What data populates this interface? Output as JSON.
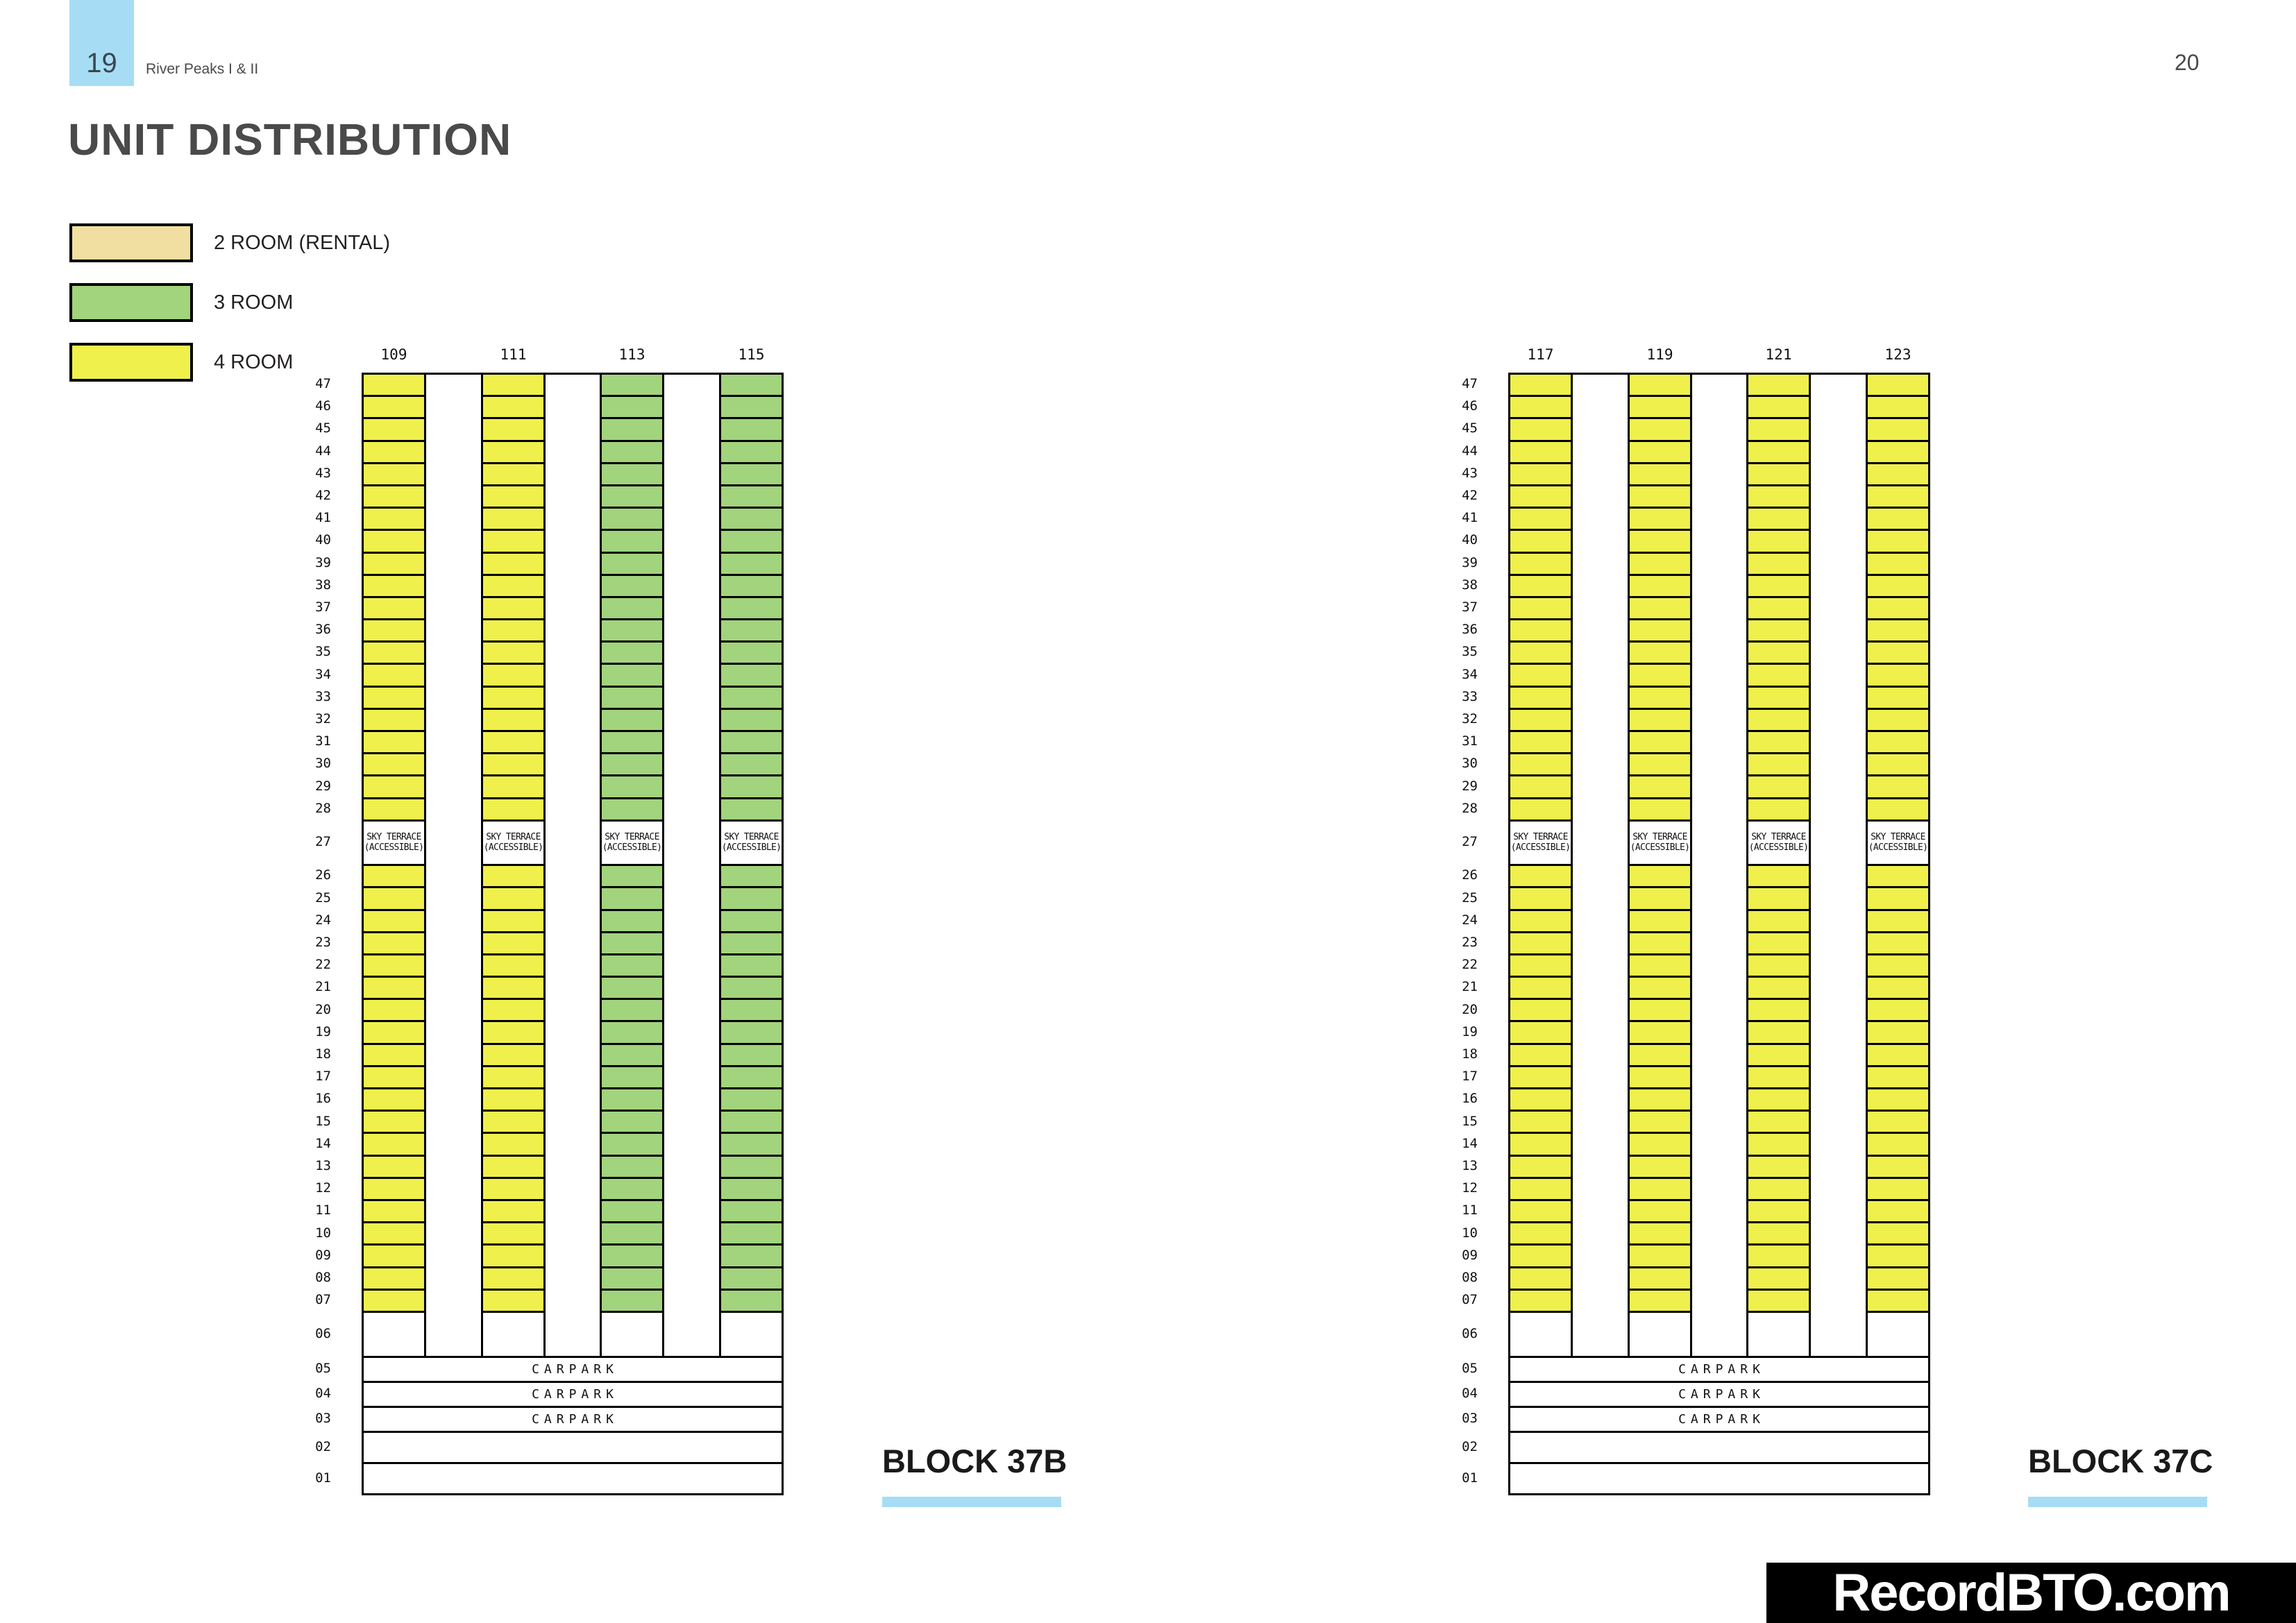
{
  "page": {
    "page_number_left": "19",
    "page_number_right": "20",
    "booklet_title": "River Peaks I & II",
    "section_title": "UNIT DISTRIBUTION",
    "watermark": "RecordBTO.com"
  },
  "colors": {
    "accent_blue": "#A7DDF4",
    "room_2_rental": "#F0DFA0",
    "room_3": "#A2D37D",
    "room_4": "#F0F04C",
    "line_black": "#000000"
  },
  "legend": [
    {
      "label": "2 ROOM (RENTAL)",
      "color_key": "room_2_rental"
    },
    {
      "label": "3 ROOM",
      "color_key": "room_3"
    },
    {
      "label": "4 ROOM",
      "color_key": "room_4"
    }
  ],
  "diagram": {
    "upper_floors": [
      "47",
      "46",
      "45",
      "44",
      "43",
      "42",
      "41",
      "40",
      "39",
      "38",
      "37",
      "36",
      "35",
      "34",
      "33",
      "32",
      "31",
      "30",
      "29",
      "28"
    ],
    "sky_terrace_floor": "27",
    "sky_terrace_label_line1": "SKY TERRACE",
    "sky_terrace_label_line2": "(ACCESSIBLE)",
    "lower_floors": [
      "26",
      "25",
      "24",
      "23",
      "22",
      "21",
      "20",
      "19",
      "18",
      "17",
      "16",
      "15",
      "14",
      "13",
      "12",
      "11",
      "10",
      "09",
      "08",
      "07"
    ],
    "void_floor": "06",
    "carpark_floors": [
      "05",
      "04",
      "03"
    ],
    "carpark_label": "CARPARK",
    "empty_floors": [
      "02",
      "01"
    ],
    "blocks": [
      {
        "name": "BLOCK 37B",
        "stacks": [
          {
            "unit": "109",
            "room_type": "4 ROOM"
          },
          {
            "unit": "111",
            "room_type": "4 ROOM"
          },
          {
            "unit": "113",
            "room_type": "3 ROOM"
          },
          {
            "unit": "115",
            "room_type": "3 ROOM"
          }
        ]
      },
      {
        "name": "BLOCK 37C",
        "stacks": [
          {
            "unit": "117",
            "room_type": "4 ROOM"
          },
          {
            "unit": "119",
            "room_type": "4 ROOM"
          },
          {
            "unit": "121",
            "room_type": "4 ROOM"
          },
          {
            "unit": "123",
            "room_type": "4 ROOM"
          }
        ]
      }
    ]
  }
}
